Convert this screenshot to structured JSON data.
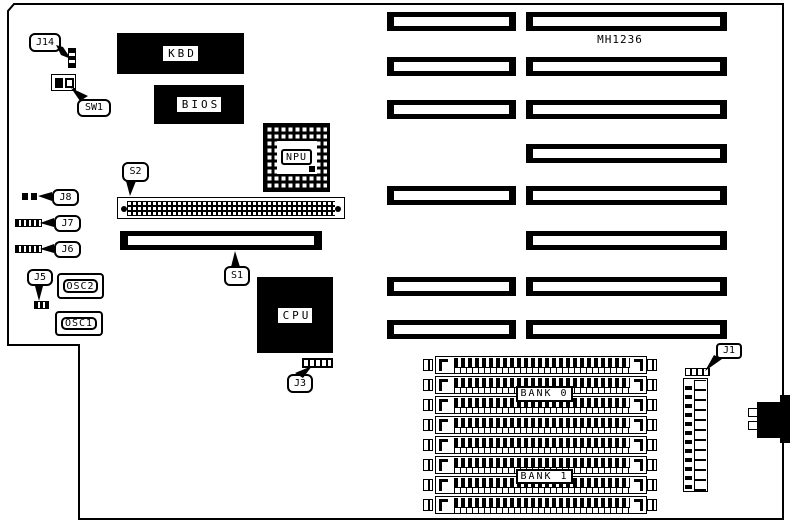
{
  "board": {
    "model": "MH1236",
    "colors": {
      "foreground": "#000000",
      "background": "#ffffff"
    },
    "callouts": {
      "j14": "J14",
      "sw1": "SW1",
      "s2": "S2",
      "s1": "S1",
      "j8": "J8",
      "j7": "J7",
      "j6": "J6",
      "j5": "J5",
      "j3": "J3",
      "j1": "J1"
    },
    "chips": {
      "kbd": "KBD",
      "bios": "BIOS",
      "npu": "NPU",
      "cpu": "CPU",
      "osc2": "OSC2",
      "osc1": "OSC1"
    },
    "memory": {
      "bank0": "BANK 0",
      "bank1": "BANK 1",
      "socket_count": 8
    },
    "expansion": {
      "left_slot_count": 6,
      "right_slot_count": 8
    }
  }
}
